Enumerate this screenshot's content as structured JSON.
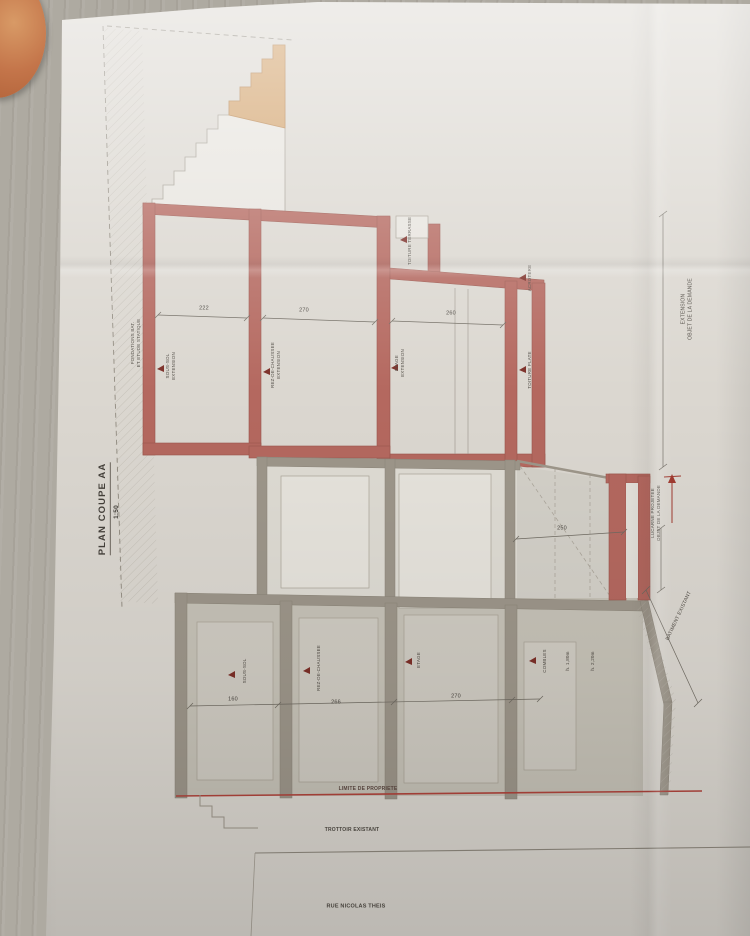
{
  "titleblock": {
    "title": "PLAN COUPE AA",
    "scale": "1:50"
  },
  "labels": {
    "fondations_1": "FONDATIONS BAT.",
    "fondations_2": "ET ETUDE STATIQUE",
    "sous_sol_extension_1": "SOUS-SOL",
    "sous_sol_extension_2": "EXTENSION",
    "rdc_extension_1": "REZ-DE-CHAUSSEE",
    "rdc_extension_2": "EXTENSION",
    "etage_extension_1": "ETAGE",
    "etage_extension_2": "EXTENSION",
    "toiture_terrasse": "TOITURE TERRASSE",
    "acrotere": "ACROTERE",
    "toiture_plate": "TOITURE PLATE",
    "extension_demande_1": "EXTENSION",
    "extension_demande_2": "OBJET DE LA DEMANDE",
    "lucarne_1": "LUCARNE PROJETEE",
    "lucarne_2": "OBJET DE LA DEMANDE",
    "batiment_existant": "BATIMENT EXISTANT",
    "sous_sol": "SOUS-SOL",
    "rez_de_chaussee": "REZ-DE-CHAUSSEE",
    "etage": "ETAGE",
    "combles": "COMBLES",
    "hauteur_gauche": "h. 1,80m",
    "hauteur_droite": "h. 2,20m",
    "limite_propriete": "LIMITE DE PROPRIETE",
    "trottoir": "TROTTOIR EXISTANT",
    "rue": "RUE NICOLAS THEIS"
  },
  "dimensions": {
    "extension_sous_sol": "222",
    "extension_rdc": "270",
    "extension_etage": "260",
    "lucarne_largeur": "250",
    "existant_sous_sol": "160",
    "existant_rdc": "266",
    "existant_etage": "270"
  },
  "colors": {
    "wall_new_red": "#b4685f",
    "stairs_tan": "#d2a26b",
    "wall_existing_gray": "#9d968a",
    "property_line_red": "#b0443c",
    "paper": "#dbd7d0"
  }
}
